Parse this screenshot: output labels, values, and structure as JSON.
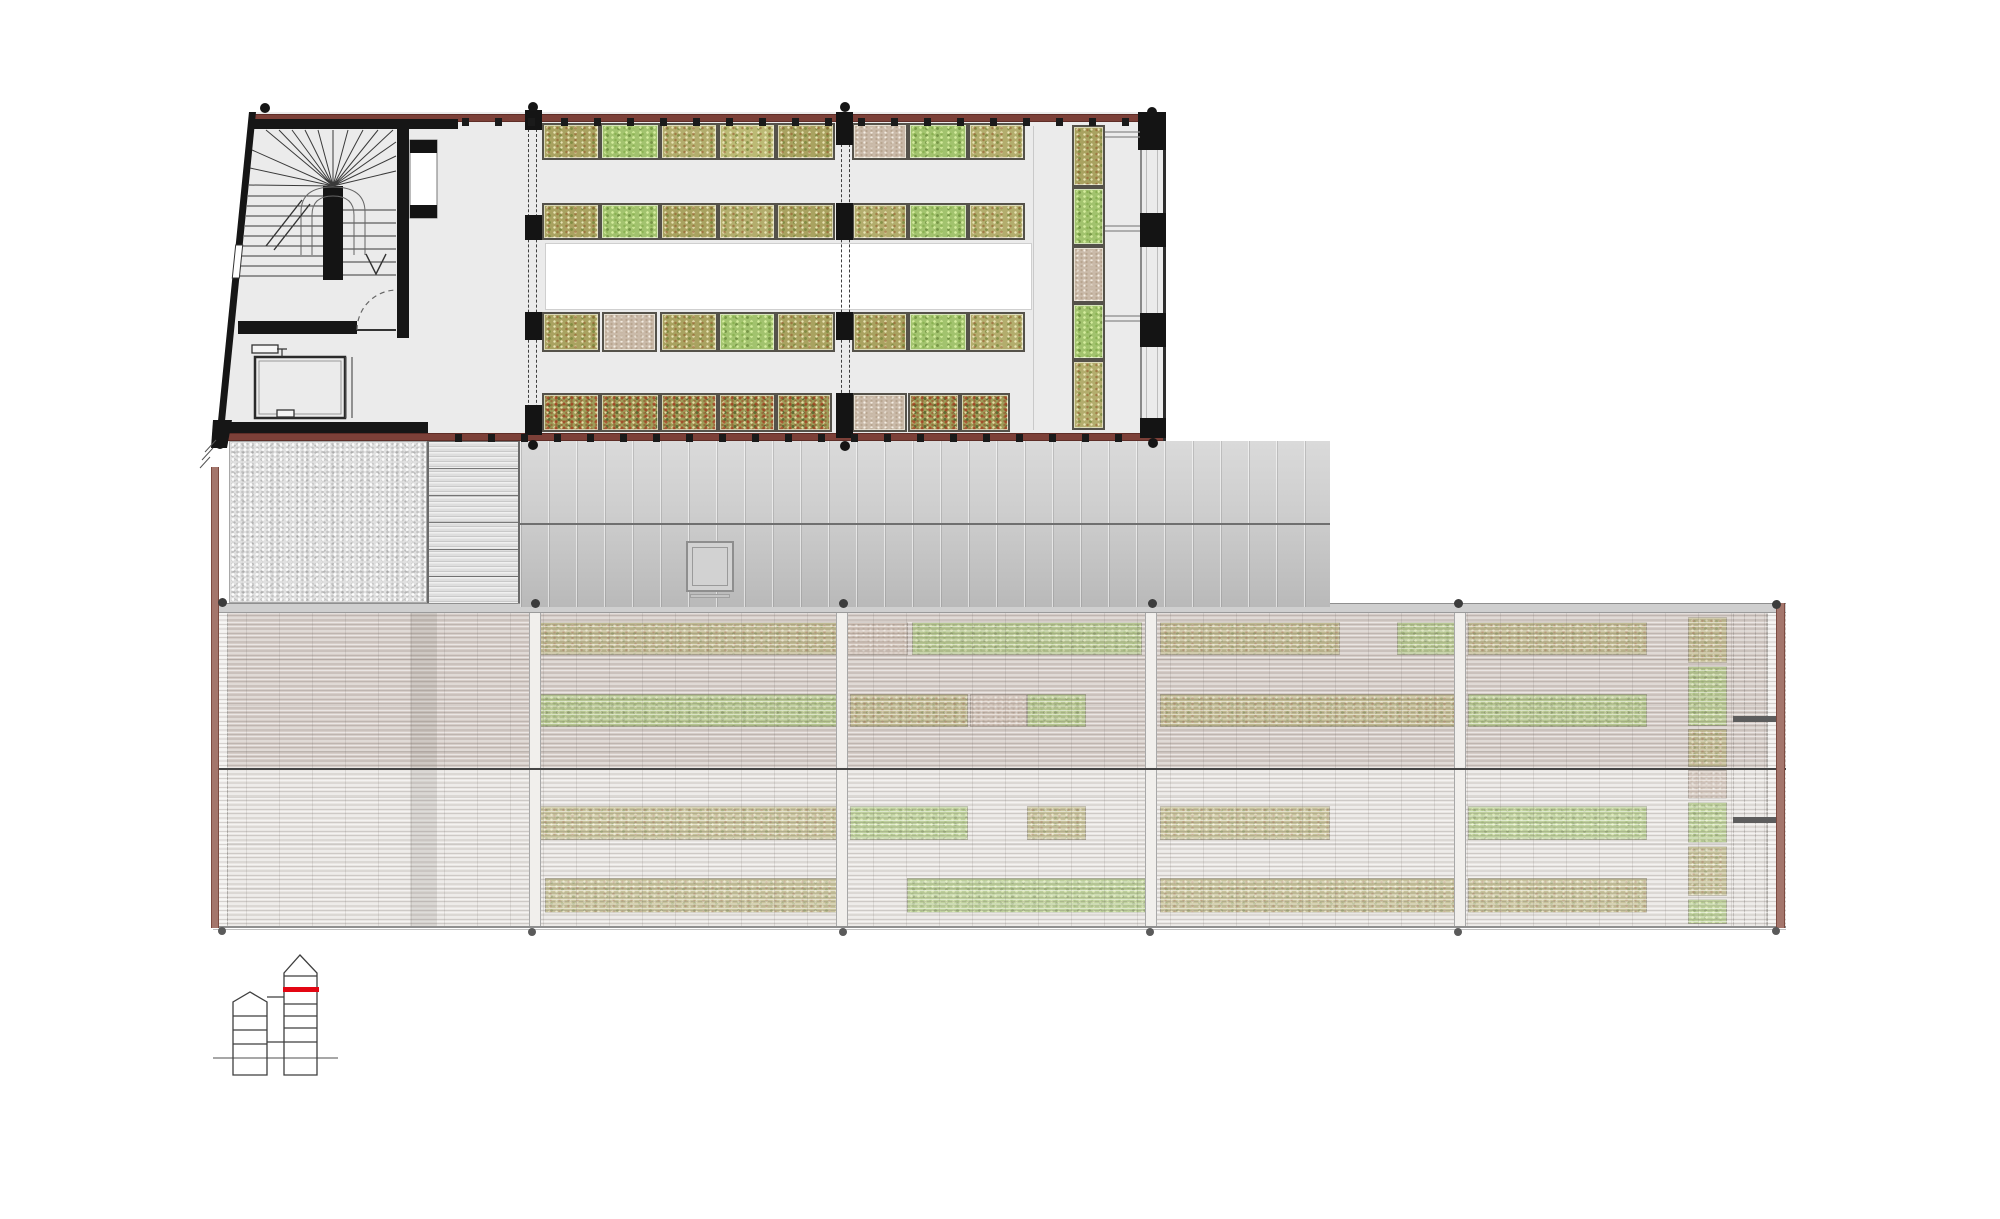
{
  "canvas": {
    "width": 2000,
    "height": 1219,
    "background": "#ffffff"
  },
  "palette": {
    "wall_black": "#161616",
    "band_red": "#7c4038",
    "band_red_dark": "#5f2d27",
    "floor_gray": "#ebebeb",
    "work_area_white": "#ffffff",
    "bed_border": "#55524a",
    "bed_olive": "#b3ad6d",
    "bed_green": "#a2c36e",
    "bed_olive_red": "#a9a260",
    "bed_dense_red": "#9d9c58",
    "bed_empty_tan": "#cabaa9",
    "gh_empty_pink": "#cdbbaf",
    "gravel_gray": "#e0e0e0",
    "roof_metal_hi": "#dadada",
    "roof_metal_lo": "#b9b9b9",
    "gh_upper_tint": "#d6cdc8",
    "gh_lower_tint": "#e9e6e3",
    "gh_side_wall_red": "#a4766c",
    "marker_red": "#e30613",
    "keyplan_line": "#3f3f3f"
  },
  "upper_building": {
    "bed_rows": [
      {
        "y": 123,
        "h": 37,
        "segments": [
          [
            542,
            58,
            "t-olivered"
          ],
          [
            600,
            60,
            "t-green"
          ],
          [
            660,
            58,
            "t-olive"
          ],
          [
            718,
            58,
            "t-yolive"
          ],
          [
            776,
            59,
            "t-olivered"
          ],
          [
            852,
            56,
            "t-tan"
          ],
          [
            908,
            60,
            "t-green"
          ],
          [
            968,
            57,
            "t-olive"
          ]
        ]
      },
      {
        "y": 203,
        "h": 37,
        "segments": [
          [
            542,
            58,
            "t-olivered"
          ],
          [
            600,
            60,
            "t-green"
          ],
          [
            660,
            58,
            "t-olivered"
          ],
          [
            718,
            58,
            "t-olive"
          ],
          [
            776,
            59,
            "t-olivered"
          ],
          [
            852,
            56,
            "t-olive"
          ],
          [
            908,
            60,
            "t-green"
          ],
          [
            968,
            57,
            "t-olive"
          ]
        ]
      },
      {
        "y": 312,
        "h": 40,
        "segments": [
          [
            542,
            58,
            "t-olivered"
          ],
          [
            602,
            55,
            "t-tan"
          ],
          [
            660,
            58,
            "t-olivered"
          ],
          [
            718,
            58,
            "t-green"
          ],
          [
            776,
            59,
            "t-olivered"
          ],
          [
            852,
            56,
            "t-olivered"
          ],
          [
            908,
            60,
            "t-green"
          ],
          [
            968,
            57,
            "t-olive"
          ]
        ]
      },
      {
        "y": 393,
        "h": 39,
        "segments": [
          [
            542,
            58,
            "t-dense"
          ],
          [
            600,
            60,
            "t-dense"
          ],
          [
            660,
            58,
            "t-dense"
          ],
          [
            718,
            58,
            "t-dense"
          ],
          [
            776,
            56,
            "t-dense"
          ],
          [
            852,
            55,
            "t-tan"
          ],
          [
            908,
            52,
            "t-dense"
          ],
          [
            960,
            50,
            "t-dense"
          ]
        ]
      }
    ],
    "vertical_strip": {
      "x": 1072,
      "w": 33,
      "segments": [
        [
          125,
          62,
          "t-olivered"
        ],
        [
          187,
          59,
          "t-green"
        ],
        [
          246,
          57,
          "t-tan"
        ],
        [
          303,
          57,
          "t-green"
        ],
        [
          360,
          70,
          "t-olive"
        ]
      ]
    },
    "columns": [
      [
        525,
        110,
        17,
        20
      ],
      [
        836,
        112,
        17,
        33
      ],
      [
        1138,
        112,
        28,
        38
      ],
      [
        525,
        215,
        17,
        25
      ],
      [
        836,
        203,
        17,
        37
      ],
      [
        1140,
        213,
        26,
        34
      ],
      [
        525,
        312,
        17,
        28
      ],
      [
        836,
        312,
        17,
        28
      ],
      [
        1140,
        313,
        26,
        34
      ],
      [
        525,
        405,
        17,
        30
      ],
      [
        836,
        393,
        17,
        45
      ],
      [
        1140,
        418,
        26,
        20
      ]
    ],
    "wall_ticks": [
      {
        "y": 118,
        "h": 8,
        "w": 7,
        "from": 462,
        "to": 1130,
        "step": 33
      },
      {
        "y": 434,
        "h": 8,
        "w": 7,
        "from": 455,
        "to": 1130,
        "step": 33
      }
    ]
  },
  "dots": [
    {
      "r": 5,
      "color": "#151515",
      "points": [
        [
          265,
          108
        ],
        [
          533,
          107
        ],
        [
          845,
          107
        ],
        [
          1152,
          112
        ],
        [
          220,
          444
        ],
        [
          533,
          445
        ],
        [
          845,
          446
        ],
        [
          1153,
          443
        ]
      ]
    },
    {
      "r": 4.5,
      "color": "#3c3c3c",
      "points": [
        [
          222,
          602
        ],
        [
          535,
          603
        ],
        [
          843,
          603
        ],
        [
          1152,
          603
        ],
        [
          1458,
          603
        ],
        [
          1776,
          604
        ]
      ]
    },
    {
      "r": 4,
      "color": "#5a5a5a",
      "points": [
        [
          222,
          931
        ],
        [
          532,
          932
        ],
        [
          843,
          932
        ],
        [
          1150,
          932
        ],
        [
          1458,
          932
        ],
        [
          1776,
          931
        ]
      ]
    }
  ],
  "greenhouse": {
    "mullions_x": [
      535,
      842,
      1151,
      1460
    ],
    "bed_rows": [
      {
        "y": 622,
        "h": 33,
        "segments": [
          [
            540,
            297,
            "t-olive"
          ],
          [
            845,
            63,
            "t-pink"
          ],
          [
            912,
            230,
            "t-green"
          ],
          [
            1160,
            180,
            "t-olive"
          ],
          [
            1397,
            58,
            "t-green"
          ],
          [
            1468,
            179,
            "t-olive"
          ]
        ]
      },
      {
        "y": 694,
        "h": 33,
        "segments": [
          [
            540,
            297,
            "t-green"
          ],
          [
            850,
            118,
            "t-olive"
          ],
          [
            970,
            57,
            "t-pink"
          ],
          [
            1027,
            59,
            "t-green"
          ],
          [
            1160,
            300,
            "t-olive"
          ],
          [
            1468,
            179,
            "t-green"
          ]
        ]
      },
      {
        "y": 806,
        "h": 34,
        "segments": [
          [
            540,
            297,
            "t-olive"
          ],
          [
            850,
            118,
            "t-green"
          ],
          [
            1027,
            59,
            "t-olive"
          ],
          [
            1160,
            170,
            "t-olive"
          ],
          [
            1468,
            179,
            "t-green"
          ]
        ]
      },
      {
        "y": 878,
        "h": 35,
        "segments": [
          [
            545,
            292,
            "t-olive"
          ],
          [
            907,
            243,
            "t-green"
          ],
          [
            1160,
            298,
            "t-olive"
          ],
          [
            1468,
            179,
            "t-olive"
          ]
        ]
      }
    ],
    "strip": {
      "x": 1688,
      "w": 39,
      "segments": [
        [
          617,
          46,
          "t-olive"
        ],
        [
          666,
          60,
          "t-green"
        ],
        [
          729,
          38,
          "t-olive"
        ],
        [
          770,
          29,
          "t-pink"
        ],
        [
          802,
          41,
          "t-green"
        ],
        [
          846,
          50,
          "t-olive"
        ],
        [
          899,
          25,
          "t-green"
        ]
      ]
    }
  },
  "key_plan": {
    "marked_level": "upper greenhouse floor",
    "marker": {
      "x": 283,
      "y": 987,
      "w": 36,
      "h": 5
    }
  }
}
